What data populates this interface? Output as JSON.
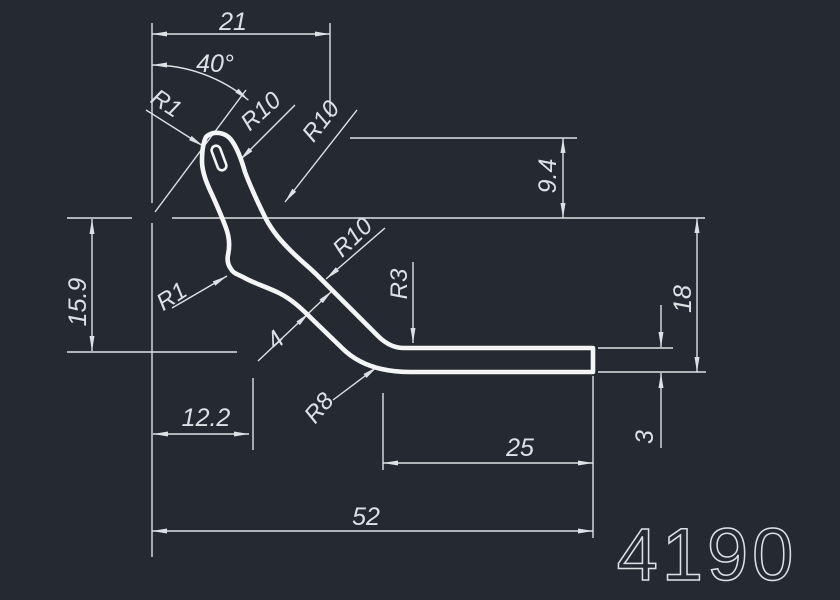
{
  "drawing": {
    "part_number": "4190",
    "units_note": "",
    "colors": {
      "background": "#252a32",
      "line": "#dde1e6",
      "profile": "#f4f5f7"
    },
    "labels": {
      "dim21": "21",
      "angle40": "40°",
      "r1Top": "R1",
      "r10A": "R10",
      "r10B": "R10",
      "dim94": "9.4",
      "dim159": "15.9",
      "r10Mid": "R10",
      "r1Low": "R1",
      "dim4": "4",
      "r3": "R3",
      "dim18": "18",
      "r8": "R8",
      "dim122": "12.2",
      "dim3": "3",
      "dim25": "25",
      "dim52": "52"
    },
    "dimension_values": {
      "linear": [
        21,
        52,
        25,
        12.2,
        15.9,
        9.4,
        18,
        4,
        3
      ],
      "angular_deg": [
        40
      ],
      "radii": [
        "R1",
        "R1",
        "R3",
        "R8",
        "R10",
        "R10",
        "R10"
      ]
    }
  }
}
